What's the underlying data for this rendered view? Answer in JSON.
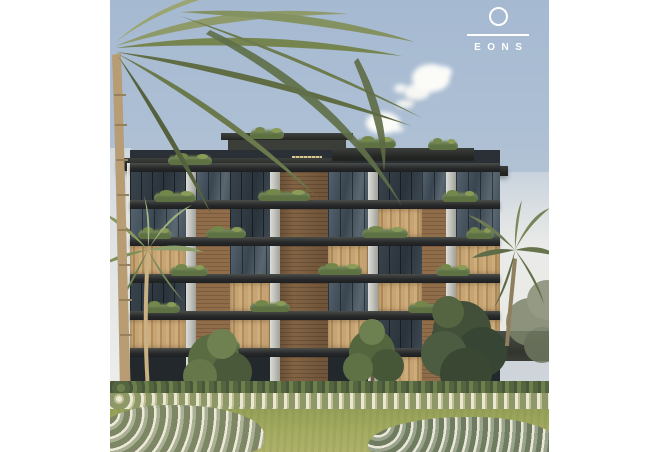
{
  "logo": {
    "brand": "EONS",
    "text": "EONS",
    "color": "#ffffff",
    "mark": "circle-over-line"
  },
  "scene": {
    "type": "architectural-rendering",
    "subject": "modern-residential-apartment-building",
    "elements": [
      "sky",
      "clouds",
      "palm-trees",
      "apartment-building",
      "balcony-planters",
      "garden-hedge",
      "white-flower-row",
      "lawn",
      "foreground-flower-bushes",
      "garden-fence"
    ],
    "colors": {
      "page_background": "#ffffff",
      "sky_top": "#a5b9d1",
      "sky_bottom": "#d6dadd",
      "roof_slab": "#2c2e2c",
      "facade_brick": "#8a6746",
      "facade_concrete": "#c9cbc5",
      "glass": "#46525c",
      "curtain": "#c4a273",
      "foliage": "#5e7245",
      "palm_frond": "#7f8c58",
      "trunk": "#b79c74",
      "lawn": "#a2aa60",
      "flowers": "#e9e6d3",
      "fence": "#3b403a"
    }
  }
}
